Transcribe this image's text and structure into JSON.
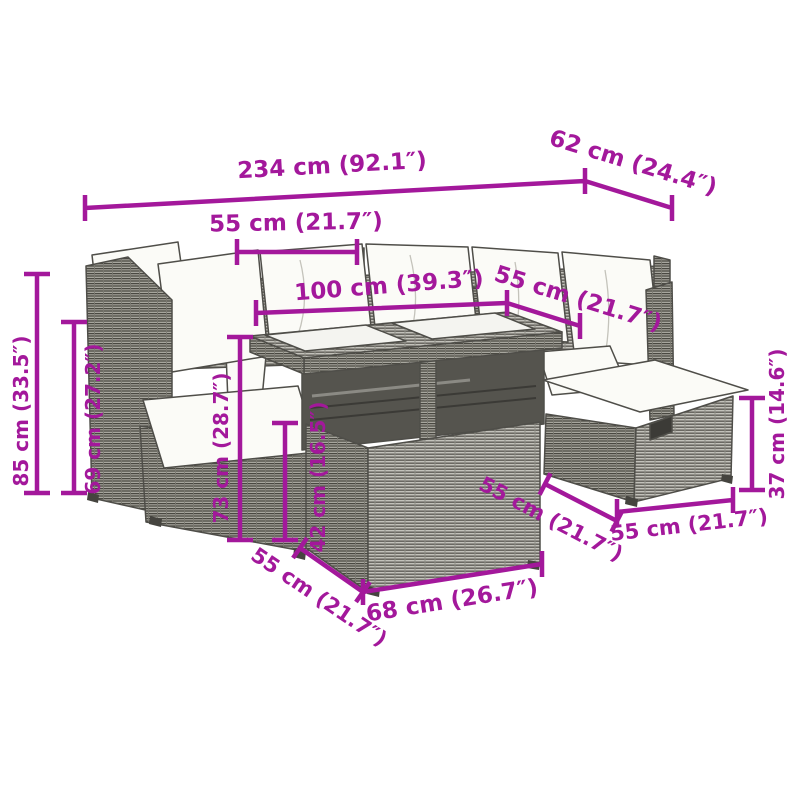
{
  "diagram": {
    "accent_color": "#a3189b",
    "line_color": "#4f4e49",
    "cushion_color": "#fbfbf7",
    "rattan_light": "#c2c1ba",
    "rattan_dark": "#a7a69e",
    "glass_color": "#f4f4f0",
    "subject": "rattan-garden-lounge-set-with-table-and-stool"
  },
  "dimensions": {
    "total_width": "234 cm (92.1″)",
    "total_depth": "62 cm (24.4″)",
    "left_section_width": "55 cm (21.7″)",
    "table_length": "100 cm (39.3″)",
    "right_section_width": "55 cm (21.7″)",
    "back_height": "85 cm (33.5″)",
    "backrest_height": "69 cm (27.2″)",
    "table_height": "73 cm (28.7″)",
    "shelf_height": "42 cm (16.5″)",
    "stool_height": "37 cm (14.6″)",
    "stool_depth": "55 cm (21.7″)",
    "stool_width": "55 cm (21.7″)",
    "table_depth": "55 cm (21.7″)",
    "table_width": "68 cm (26.7″)"
  }
}
